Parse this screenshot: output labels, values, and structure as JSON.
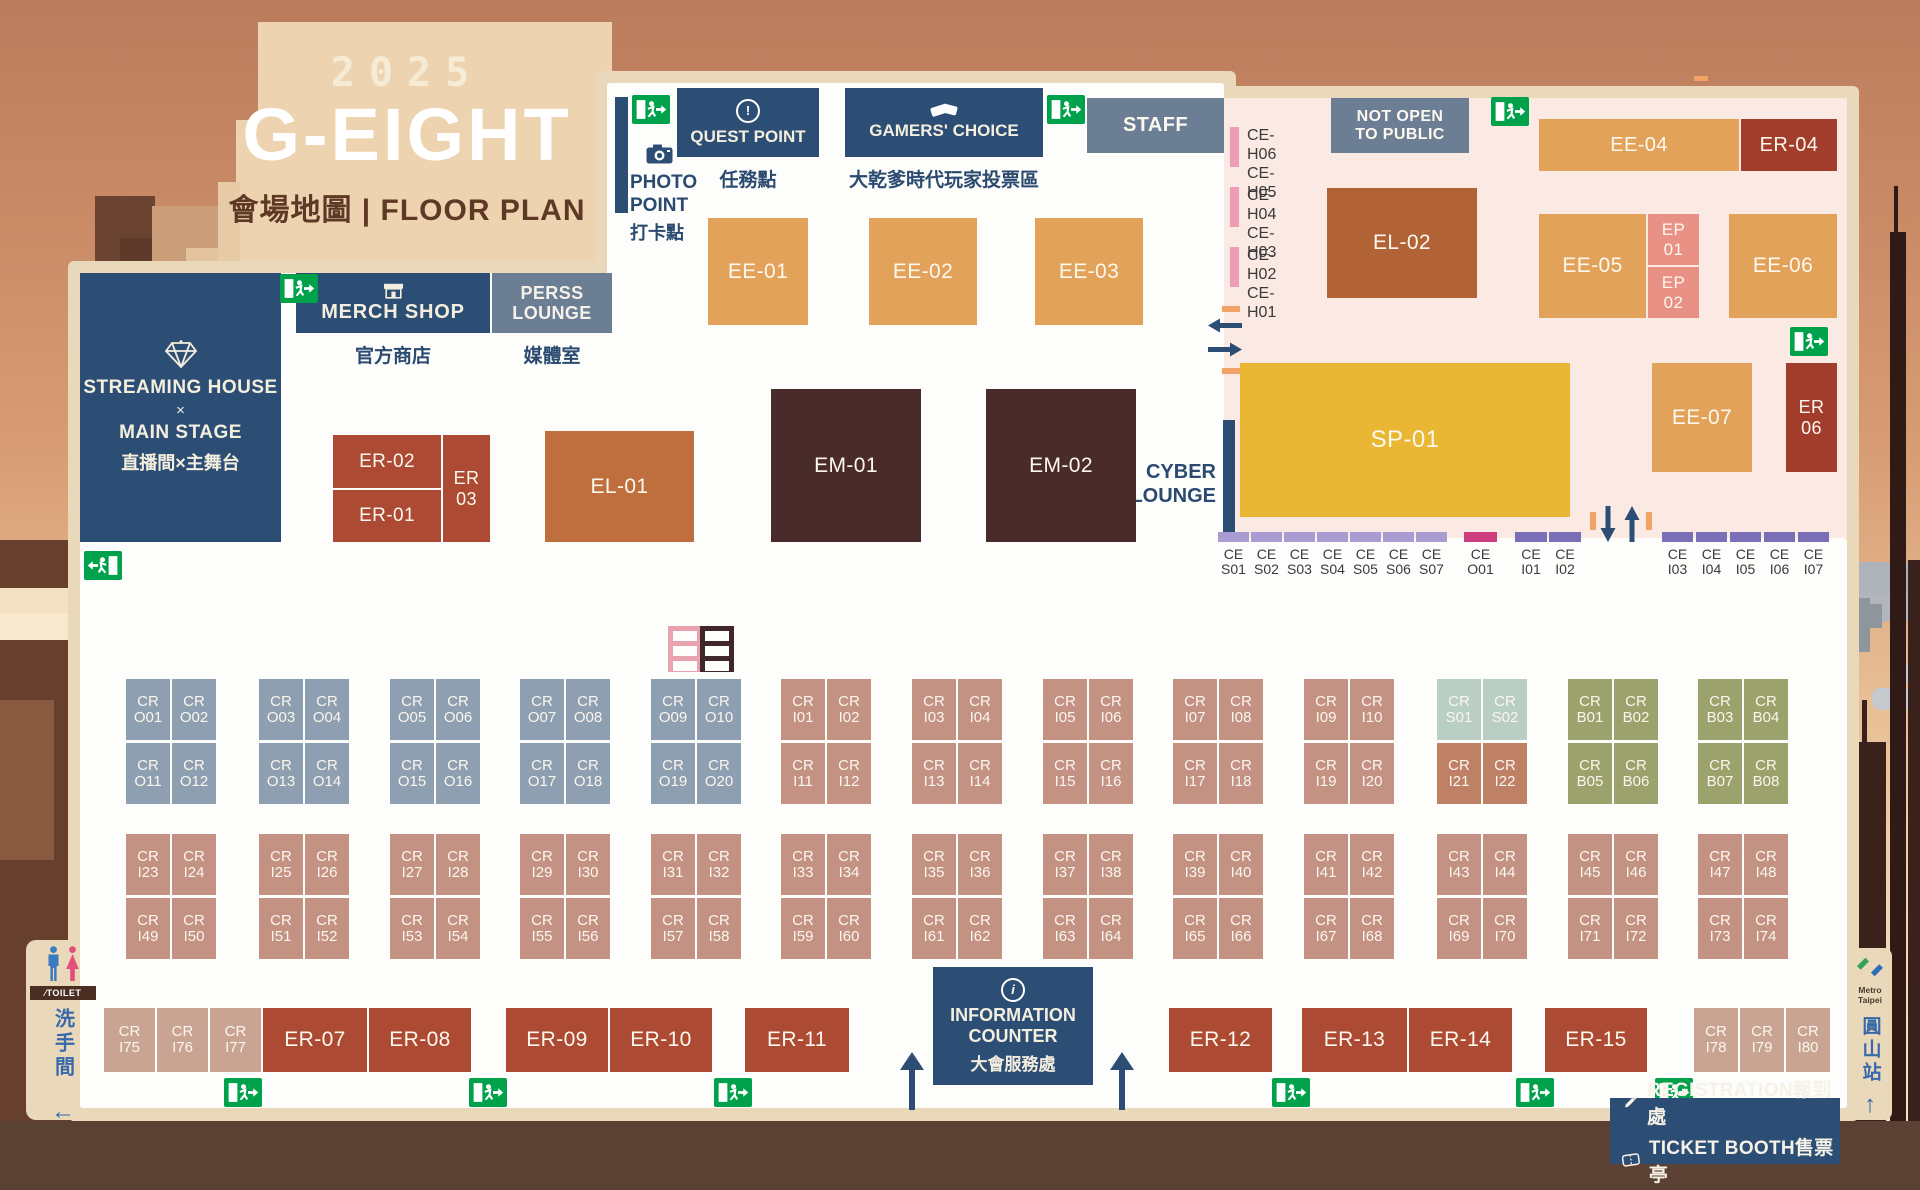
{
  "title": {
    "year": "2025",
    "name": "G-EIGHT",
    "subtitle": "會場地圖 | FLOOR PLAN"
  },
  "colors": {
    "navy": "#2d4e74",
    "gray_blue": "#6b7e94",
    "exit_green": "#00a14b",
    "ee_orange": "#e2a259",
    "er_brick": "#ad4a33",
    "el_sienna": "#b26336",
    "em_maroon": "#4a2b2b",
    "sp_yellow": "#e9b733",
    "ep_salmon": "#ea9186",
    "pink_zone": "#fbe9e4",
    "floor": "#fdfdfb",
    "border_beige": "#ead8bb",
    "cr_o": "#8d9fb0",
    "cr_i": "#c39282",
    "cr_s": "#b9cfc5",
    "cr_b": "#9ba26b",
    "ce_lavender": "#a89cd0",
    "ce_purple": "#7b70b8",
    "ce_magenta": "#cd3d7d",
    "ce_h_pink": "#ef9cb7"
  },
  "icons": {
    "quest": "exclamation-circle",
    "quest_glyph": "!",
    "gamers": "ballot-cards",
    "merch": "storefront",
    "photo": "camera",
    "streaming": "diamond",
    "info": "info-circle",
    "info_glyph": "i",
    "exit": "running-man-exit",
    "registration": "pencil",
    "ticket": "ticket",
    "toilet": "male-female-figures",
    "metro": "metro-taipei-logo"
  },
  "top": {
    "quest_point": {
      "label": "QUEST POINT",
      "caption": "任務點"
    },
    "gamers_choice": {
      "label": "GAMERS' CHOICE",
      "caption": "大乾爹時代玩家投票區"
    },
    "photo_point": {
      "line1": "PHOTO",
      "line2": "POINT",
      "caption": "打卡點"
    }
  },
  "left": {
    "streaming": {
      "lines": [
        "STREAMING HOUSE",
        "×",
        "MAIN STAGE",
        "直播間×主舞台"
      ]
    },
    "merch": {
      "label": "MERCH SHOP",
      "caption": "官方商店"
    },
    "press": {
      "label": "PERSS\nLOUNGE",
      "caption": "媒體室"
    }
  },
  "cyber_lounge": "CYBER\nLOUNGE",
  "info_counter": {
    "line1": "INFORMATION",
    "line2": "COUNTER",
    "caption": "大會服務處"
  },
  "toilet": {
    "sign": "TOILET",
    "caption": "洗手間",
    "arrow": "←"
  },
  "metro": {
    "brand": "Metro Taipei",
    "station": "圓山站",
    "arrow": "↑"
  },
  "legend": {
    "registration": "REGISTRATION報到處",
    "ticket": "TICKET BOOTH售票亭"
  },
  "blocks": [
    {
      "label": "EE-01",
      "x": 708,
      "y": 218,
      "w": 100,
      "h": 107,
      "c": "ee"
    },
    {
      "label": "EE-02",
      "x": 869,
      "y": 218,
      "w": 108,
      "h": 107,
      "c": "ee"
    },
    {
      "label": "EE-03",
      "x": 1035,
      "y": 218,
      "w": 108,
      "h": 107,
      "c": "ee"
    },
    {
      "label": "EE-04",
      "x": 1539,
      "y": 119,
      "w": 200,
      "h": 52,
      "c": "ee",
      "fs": 20
    },
    {
      "label": "ER-04",
      "x": 1741,
      "y": 119,
      "w": 96,
      "h": 52,
      "c": "erd",
      "fs": 20
    },
    {
      "label": "EL-02",
      "x": 1327,
      "y": 188,
      "w": 150,
      "h": 110,
      "c": "el"
    },
    {
      "label": "EE-05",
      "x": 1539,
      "y": 214,
      "w": 107,
      "h": 104,
      "c": "ee"
    },
    {
      "label": "EP\n01",
      "x": 1648,
      "y": 214,
      "w": 51,
      "h": 51,
      "c": "ep",
      "fs": 17
    },
    {
      "label": "EP\n02",
      "x": 1648,
      "y": 267,
      "w": 51,
      "h": 51,
      "c": "ep",
      "fs": 17
    },
    {
      "label": "EE-06",
      "x": 1729,
      "y": 214,
      "w": 108,
      "h": 104,
      "c": "ee"
    },
    {
      "label": "SP-01",
      "x": 1240,
      "y": 363,
      "w": 330,
      "h": 154,
      "c": "sp",
      "fs": 24
    },
    {
      "label": "EE-07",
      "x": 1652,
      "y": 363,
      "w": 100,
      "h": 109,
      "c": "ee"
    },
    {
      "label": "ER\n06",
      "x": 1786,
      "y": 363,
      "w": 51,
      "h": 109,
      "c": "erd",
      "fs": 18
    },
    {
      "label": "EM-01",
      "x": 771,
      "y": 389,
      "w": 150,
      "h": 153,
      "c": "em"
    },
    {
      "label": "EM-02",
      "x": 986,
      "y": 389,
      "w": 150,
      "h": 153,
      "c": "em"
    },
    {
      "label": "EL-01",
      "x": 545,
      "y": 431,
      "w": 149,
      "h": 111,
      "c": "el2"
    },
    {
      "label": "ER-02",
      "x": 333,
      "y": 435,
      "w": 108,
      "h": 53,
      "c": "er",
      "fs": 19
    },
    {
      "label": "ER-01",
      "x": 333,
      "y": 490,
      "w": 108,
      "h": 52,
      "c": "er",
      "fs": 19
    },
    {
      "label": "ER\n03",
      "x": 443,
      "y": 435,
      "w": 47,
      "h": 107,
      "c": "er",
      "fs": 18
    },
    {
      "label": "STAFF",
      "x": 1087,
      "y": 98,
      "w": 137,
      "h": 55,
      "c": "gray",
      "fs": 20
    },
    {
      "label": "NOT OPEN\nTO PUBLIC",
      "x": 1331,
      "y": 98,
      "w": 138,
      "h": 55,
      "c": "gray",
      "fs": 16
    },
    {
      "label": "ER-07",
      "x": 263,
      "y": 1008,
      "w": 104,
      "h": 64,
      "c": "er"
    },
    {
      "label": "ER-08",
      "x": 369,
      "y": 1008,
      "w": 102,
      "h": 64,
      "c": "er"
    },
    {
      "label": "ER-09",
      "x": 506,
      "y": 1008,
      "w": 102,
      "h": 64,
      "c": "er"
    },
    {
      "label": "ER-10",
      "x": 610,
      "y": 1008,
      "w": 102,
      "h": 64,
      "c": "er"
    },
    {
      "label": "ER-11",
      "x": 745,
      "y": 1008,
      "w": 104,
      "h": 64,
      "c": "er"
    },
    {
      "label": "ER-12",
      "x": 1169,
      "y": 1008,
      "w": 103,
      "h": 64,
      "c": "er"
    },
    {
      "label": "ER-13",
      "x": 1302,
      "y": 1008,
      "w": 105,
      "h": 64,
      "c": "er"
    },
    {
      "label": "ER-14",
      "x": 1409,
      "y": 1008,
      "w": 103,
      "h": 64,
      "c": "er"
    },
    {
      "label": "ER-15",
      "x": 1545,
      "y": 1008,
      "w": 102,
      "h": 64,
      "c": "er"
    }
  ],
  "ceh": [
    {
      "y": 127,
      "l": "CE-H06\nCE-H05"
    },
    {
      "y": 187,
      "l": "CE-H04\nCE-H03"
    },
    {
      "y": 247,
      "l": "CE-H02\nCE-H01"
    }
  ],
  "ce": [
    {
      "x": 1218,
      "w": 31,
      "c": "lav",
      "l": "CE\nS01"
    },
    {
      "x": 1251,
      "w": 31,
      "c": "lav",
      "l": "CE\nS02"
    },
    {
      "x": 1284,
      "w": 31,
      "c": "lav",
      "l": "CE\nS03"
    },
    {
      "x": 1317,
      "w": 31,
      "c": "lav",
      "l": "CE\nS04"
    },
    {
      "x": 1350,
      "w": 31,
      "c": "lav",
      "l": "CE\nS05"
    },
    {
      "x": 1383,
      "w": 31,
      "c": "lav",
      "l": "CE\nS06"
    },
    {
      "x": 1416,
      "w": 31,
      "c": "lav",
      "l": "CE\nS07"
    },
    {
      "x": 1464,
      "w": 33,
      "c": "mag",
      "l": "CE\nO01"
    },
    {
      "x": 1515,
      "w": 32,
      "c": "pur",
      "l": "CE\nI01"
    },
    {
      "x": 1549,
      "w": 32,
      "c": "pur",
      "l": "CE\nI02"
    },
    {
      "x": 1662,
      "w": 31,
      "c": "pur",
      "l": "CE\nI03"
    },
    {
      "x": 1696,
      "w": 31,
      "c": "pur",
      "l": "CE\nI04"
    },
    {
      "x": 1730,
      "w": 31,
      "c": "pur",
      "l": "CE\nI05"
    },
    {
      "x": 1764,
      "w": 31,
      "c": "pur",
      "l": "CE\nI06"
    },
    {
      "x": 1798,
      "w": 31,
      "c": "pur",
      "l": "CE\nI07"
    }
  ],
  "cr_groups": [
    {
      "x": 126,
      "y": 679,
      "rows": [
        {
          "c": "o",
          "cells": [
            "CR O01",
            "CR O02"
          ]
        },
        {
          "c": "o",
          "cells": [
            "CR O11",
            "CR O12"
          ]
        }
      ]
    },
    {
      "x": 259,
      "y": 679,
      "rows": [
        {
          "c": "o",
          "cells": [
            "CR O03",
            "CR O04"
          ]
        },
        {
          "c": "o",
          "cells": [
            "CR O13",
            "CR O14"
          ]
        }
      ]
    },
    {
      "x": 390,
      "y": 679,
      "rows": [
        {
          "c": "o",
          "cells": [
            "CR O05",
            "CR O06"
          ]
        },
        {
          "c": "o",
          "cells": [
            "CR O15",
            "CR O16"
          ]
        }
      ]
    },
    {
      "x": 520,
      "y": 679,
      "rows": [
        {
          "c": "o",
          "cells": [
            "CR O07",
            "CR O08"
          ]
        },
        {
          "c": "o",
          "cells": [
            "CR O17",
            "CR O18"
          ]
        }
      ]
    },
    {
      "x": 651,
      "y": 679,
      "rows": [
        {
          "c": "o",
          "cells": [
            "CR O09",
            "CR O10"
          ]
        },
        {
          "c": "o",
          "cells": [
            "CR O19",
            "CR O20"
          ]
        }
      ]
    },
    {
      "x": 781,
      "y": 679,
      "rows": [
        {
          "c": "i",
          "cells": [
            "CR I01",
            "CR I02"
          ]
        },
        {
          "c": "i",
          "cells": [
            "CR I11",
            "CR I12"
          ]
        }
      ]
    },
    {
      "x": 912,
      "y": 679,
      "rows": [
        {
          "c": "i",
          "cells": [
            "CR I03",
            "CR I04"
          ]
        },
        {
          "c": "i",
          "cells": [
            "CR I13",
            "CR I14"
          ]
        }
      ]
    },
    {
      "x": 1043,
      "y": 679,
      "rows": [
        {
          "c": "i",
          "cells": [
            "CR I05",
            "CR I06"
          ]
        },
        {
          "c": "i",
          "cells": [
            "CR I15",
            "CR I16"
          ]
        }
      ]
    },
    {
      "x": 1173,
      "y": 679,
      "rows": [
        {
          "c": "i",
          "cells": [
            "CR I07",
            "CR I08"
          ]
        },
        {
          "c": "i",
          "cells": [
            "CR I17",
            "CR I18"
          ]
        }
      ]
    },
    {
      "x": 1304,
      "y": 679,
      "rows": [
        {
          "c": "i",
          "cells": [
            "CR I09",
            "CR I10"
          ]
        },
        {
          "c": "i",
          "cells": [
            "CR I19",
            "CR I20"
          ]
        }
      ]
    },
    {
      "x": 1437,
      "y": 679,
      "rows": [
        {
          "c": "s",
          "cells": [
            "CR S01",
            "CR S02"
          ]
        },
        {
          "c": "i2",
          "cells": [
            "CR I21",
            "CR I22"
          ]
        }
      ]
    },
    {
      "x": 1568,
      "y": 679,
      "rows": [
        {
          "c": "b",
          "cells": [
            "CR B01",
            "CR B02"
          ]
        },
        {
          "c": "b",
          "cells": [
            "CR B05",
            "CR B06"
          ]
        }
      ]
    },
    {
      "x": 1698,
      "y": 679,
      "rows": [
        {
          "c": "b",
          "cells": [
            "CR B03",
            "CR B04"
          ]
        },
        {
          "c": "b",
          "cells": [
            "CR B07",
            "CR B08"
          ]
        }
      ]
    },
    {
      "x": 126,
      "y": 834,
      "rows": [
        {
          "c": "i",
          "cells": [
            "CR I23",
            "CR I24"
          ]
        },
        {
          "c": "i",
          "cells": [
            "CR I49",
            "CR I50"
          ]
        }
      ]
    },
    {
      "x": 259,
      "y": 834,
      "rows": [
        {
          "c": "i",
          "cells": [
            "CR I25",
            "CR I26"
          ]
        },
        {
          "c": "i",
          "cells": [
            "CR I51",
            "CR I52"
          ]
        }
      ]
    },
    {
      "x": 390,
      "y": 834,
      "rows": [
        {
          "c": "i",
          "cells": [
            "CR I27",
            "CR I28"
          ]
        },
        {
          "c": "i",
          "cells": [
            "CR I53",
            "CR I54"
          ]
        }
      ]
    },
    {
      "x": 520,
      "y": 834,
      "rows": [
        {
          "c": "i",
          "cells": [
            "CR I29",
            "CR I30"
          ]
        },
        {
          "c": "i",
          "cells": [
            "CR I55",
            "CR I56"
          ]
        }
      ]
    },
    {
      "x": 651,
      "y": 834,
      "rows": [
        {
          "c": "i",
          "cells": [
            "CR I31",
            "CR I32"
          ]
        },
        {
          "c": "i",
          "cells": [
            "CR I57",
            "CR I58"
          ]
        }
      ]
    },
    {
      "x": 781,
      "y": 834,
      "rows": [
        {
          "c": "i",
          "cells": [
            "CR I33",
            "CR I34"
          ]
        },
        {
          "c": "i",
          "cells": [
            "CR I59",
            "CR I60"
          ]
        }
      ]
    },
    {
      "x": 912,
      "y": 834,
      "rows": [
        {
          "c": "i",
          "cells": [
            "CR I35",
            "CR I36"
          ]
        },
        {
          "c": "i",
          "cells": [
            "CR I61",
            "CR I62"
          ]
        }
      ]
    },
    {
      "x": 1043,
      "y": 834,
      "rows": [
        {
          "c": "i",
          "cells": [
            "CR I37",
            "CR I38"
          ]
        },
        {
          "c": "i",
          "cells": [
            "CR I63",
            "CR I64"
          ]
        }
      ]
    },
    {
      "x": 1173,
      "y": 834,
      "rows": [
        {
          "c": "i",
          "cells": [
            "CR I39",
            "CR I40"
          ]
        },
        {
          "c": "i",
          "cells": [
            "CR I65",
            "CR I66"
          ]
        }
      ]
    },
    {
      "x": 1304,
      "y": 834,
      "rows": [
        {
          "c": "i",
          "cells": [
            "CR I41",
            "CR I42"
          ]
        },
        {
          "c": "i",
          "cells": [
            "CR I67",
            "CR I68"
          ]
        }
      ]
    },
    {
      "x": 1437,
      "y": 834,
      "rows": [
        {
          "c": "i",
          "cells": [
            "CR I43",
            "CR I44"
          ]
        },
        {
          "c": "i",
          "cells": [
            "CR I69",
            "CR I70"
          ]
        }
      ]
    },
    {
      "x": 1568,
      "y": 834,
      "rows": [
        {
          "c": "i",
          "cells": [
            "CR I45",
            "CR I46"
          ]
        },
        {
          "c": "i",
          "cells": [
            "CR I71",
            "CR I72"
          ]
        }
      ]
    },
    {
      "x": 1698,
      "y": 834,
      "rows": [
        {
          "c": "i",
          "cells": [
            "CR I47",
            "CR I48"
          ]
        },
        {
          "c": "i",
          "cells": [
            "CR I73",
            "CR I74"
          ]
        }
      ]
    }
  ],
  "cr_singles": [
    {
      "x": 104,
      "w": 51,
      "l": "CR I75"
    },
    {
      "x": 157,
      "w": 51,
      "l": "CR I76"
    },
    {
      "x": 210,
      "w": 51,
      "l": "CR I77"
    },
    {
      "x": 1694,
      "w": 44,
      "l": "CR I78"
    },
    {
      "x": 1740,
      "w": 44,
      "l": "CR I79"
    },
    {
      "x": 1786,
      "w": 44,
      "l": "CR I80"
    }
  ],
  "exits": [
    {
      "x": 632,
      "y": 95
    },
    {
      "x": 1047,
      "y": 95
    },
    {
      "x": 1491,
      "y": 97
    },
    {
      "x": 280,
      "y": 274
    },
    {
      "x": 1790,
      "y": 327
    },
    {
      "x": 84,
      "y": 551,
      "flip": true
    },
    {
      "x": 224,
      "y": 1078
    },
    {
      "x": 469,
      "y": 1078
    },
    {
      "x": 714,
      "y": 1078
    },
    {
      "x": 1272,
      "y": 1078
    },
    {
      "x": 1516,
      "y": 1078
    },
    {
      "x": 1655,
      "y": 1078
    }
  ]
}
